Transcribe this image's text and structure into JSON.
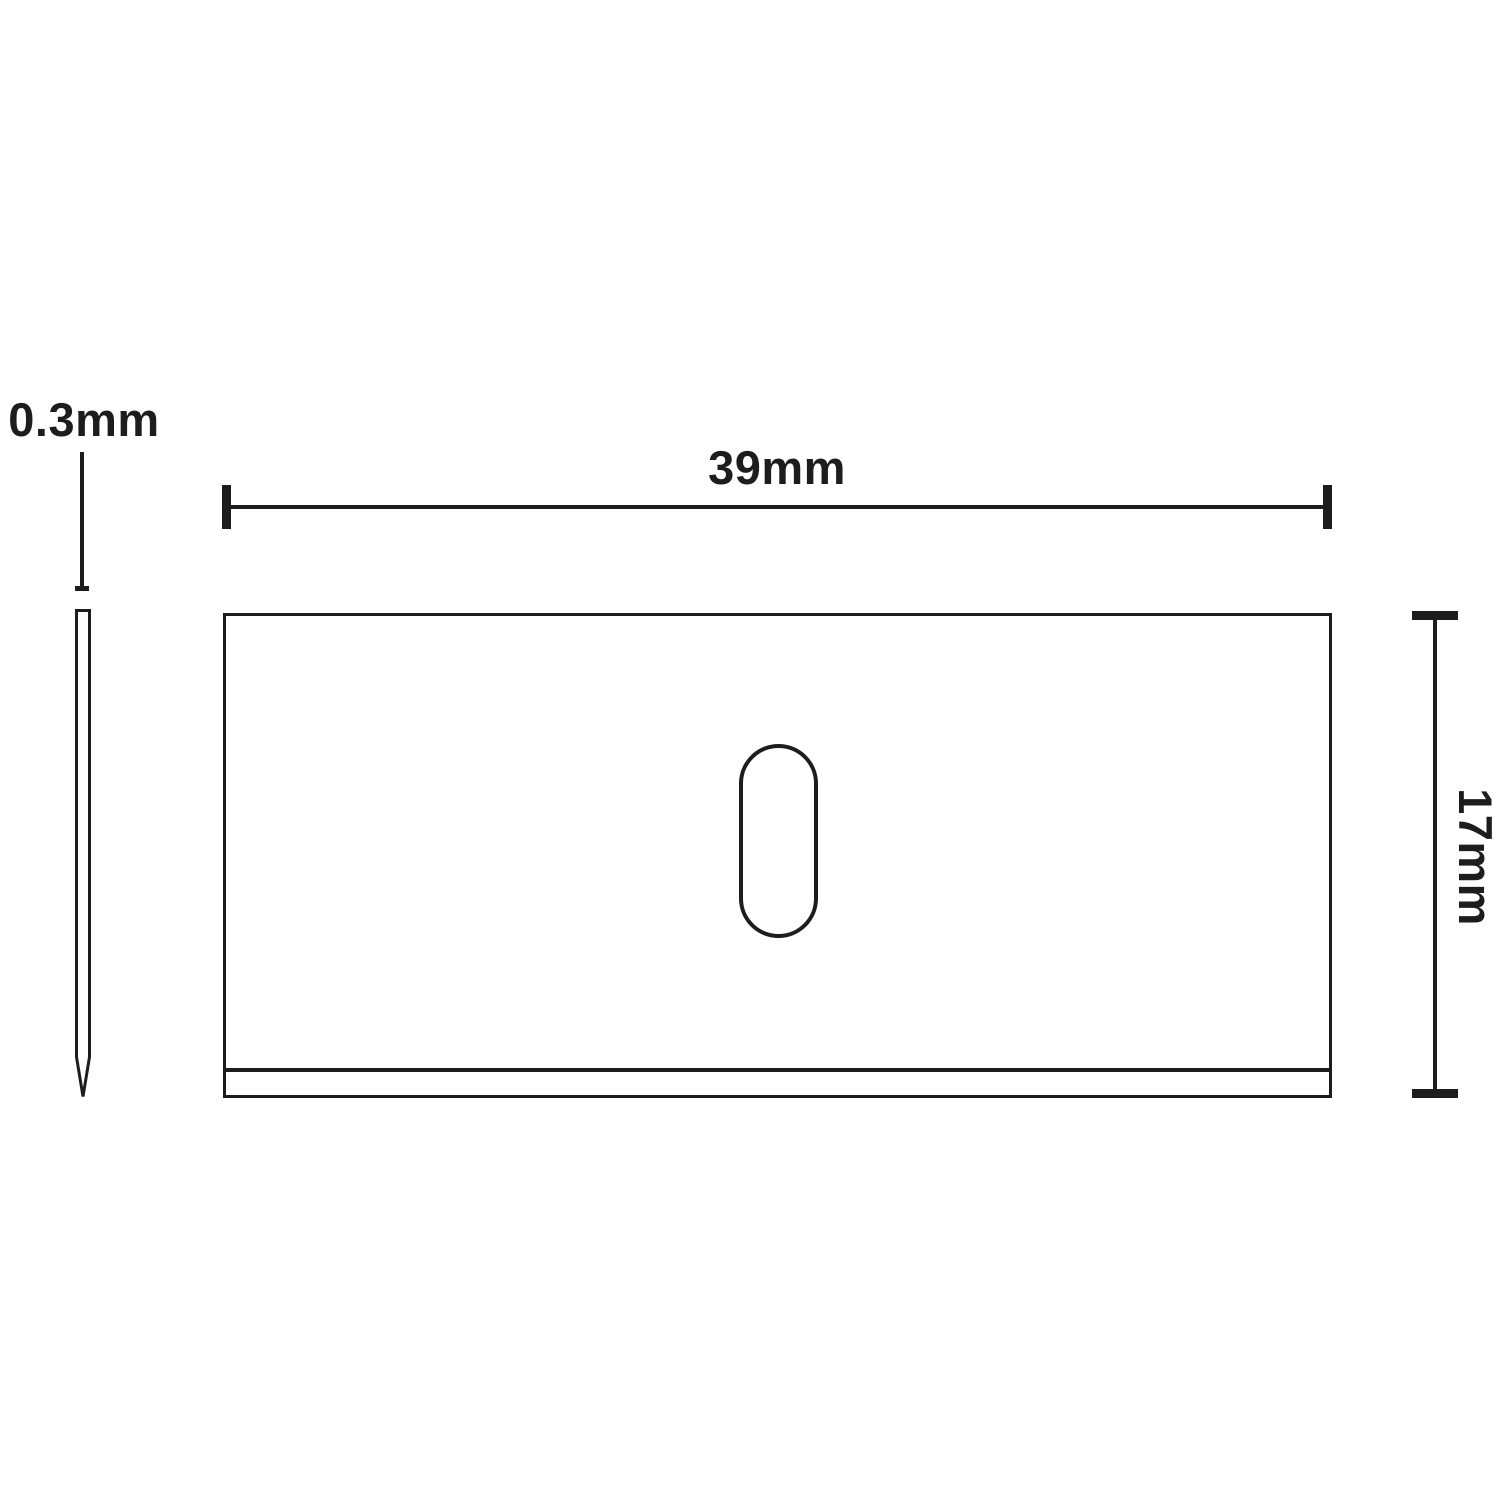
{
  "diagram": {
    "background_color": "#ffffff",
    "line_color": "#1d1d1d",
    "side_view": {
      "thickness_label": "0.3mm"
    },
    "front_view": {
      "width_label": "39mm",
      "height_label": "17mm"
    }
  }
}
